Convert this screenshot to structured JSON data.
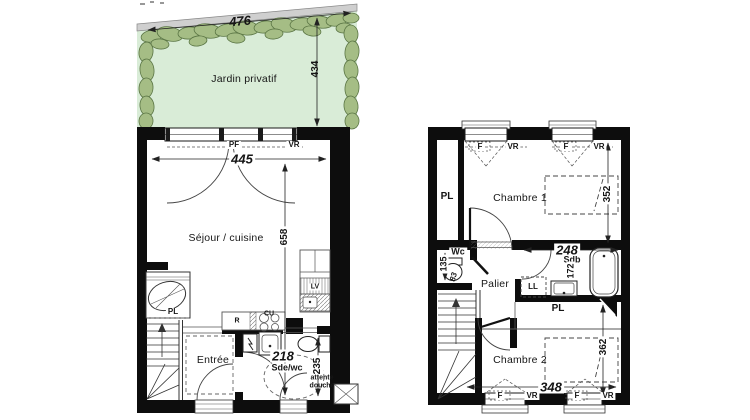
{
  "garden": {
    "label": "Jardin privatif",
    "width": "476",
    "depth": "434"
  },
  "ground": {
    "living": {
      "label": "Séjour / cuisine",
      "width": "445",
      "depth": "658"
    },
    "window_door": {
      "pf": "PF",
      "vr": "VR"
    },
    "kitchen": {
      "r": "R",
      "cu": "CU",
      "lv": "LV"
    },
    "entry": {
      "label": "Entrée"
    },
    "shower": {
      "label": "Sde/wc",
      "width": "218",
      "depth": "235",
      "note1": "attente",
      "note2": "douche"
    },
    "closet": {
      "pl": "PL"
    }
  },
  "upper": {
    "bedroom1": {
      "label": "Chambre 1",
      "depth": "352"
    },
    "bedroom2": {
      "label": "Chambre 2",
      "width": "348",
      "depth": "362"
    },
    "wc": {
      "label": "Wc",
      "depth": "135",
      "width": "83"
    },
    "bath": {
      "label": "Sdb",
      "width": "248",
      "depth": "172"
    },
    "laundry": {
      "ll": "LL"
    },
    "landing": {
      "label": "Palier"
    },
    "closet_left": {
      "pl": "PL"
    },
    "closet_bottom": {
      "pl": "PL"
    },
    "window": {
      "f": "F",
      "vr": "VR"
    }
  },
  "colors": {
    "garden_fill": "#d9ecd7",
    "hedge_fill": "#a5bd85",
    "hedge_stroke": "#5a7544",
    "wall": "#0d0d0d",
    "line": "#222222"
  }
}
